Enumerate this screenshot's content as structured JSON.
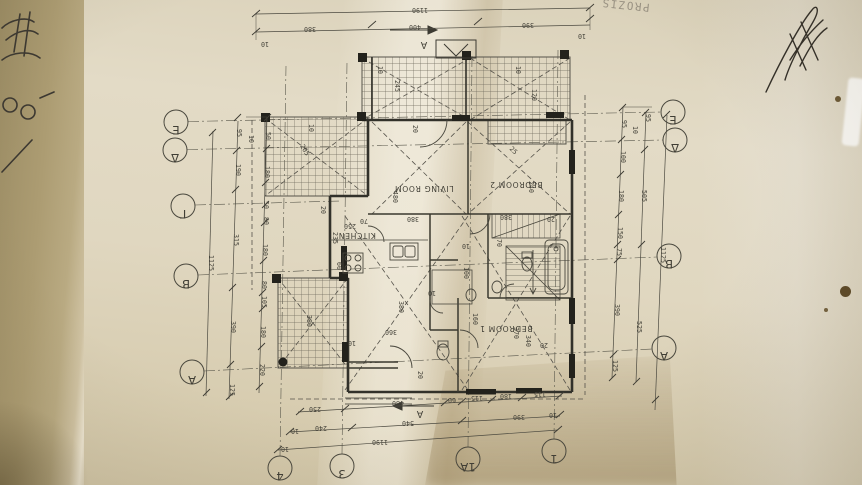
{
  "photo": {
    "stamp_text": "PROZIS",
    "description": "upside-down architectural floor plan on folded beige paper"
  },
  "colors": {
    "paper": "#e3dbc6",
    "paper_shadow": "#b3a37a",
    "ink": "#45433a",
    "wall_ink": "#32312a"
  },
  "plan": {
    "rooms": [
      {
        "label": "LIVING ROOM",
        "x": 424,
        "y": 186
      },
      {
        "label": "BEDROOM 2",
        "x": 516,
        "y": 182
      },
      {
        "label": "KITCHEN",
        "x": 357,
        "y": 233
      },
      {
        "label": "BEDROOM 1",
        "x": 506,
        "y": 326
      }
    ],
    "grid_bubbles": [
      {
        "label": "E",
        "x": 176,
        "y": 122
      },
      {
        "label": "Δ",
        "x": 175,
        "y": 150
      },
      {
        "label": "Γ",
        "x": 183,
        "y": 206
      },
      {
        "label": "B",
        "x": 186,
        "y": 276
      },
      {
        "label": "A",
        "x": 192,
        "y": 372
      },
      {
        "label": "E",
        "x": 673,
        "y": 112
      },
      {
        "label": "Δ",
        "x": 675,
        "y": 140
      },
      {
        "label": "B",
        "x": 669,
        "y": 256
      },
      {
        "label": "A",
        "x": 664,
        "y": 348
      },
      {
        "label": "4",
        "x": 280,
        "y": 468
      },
      {
        "label": "3",
        "x": 342,
        "y": 466
      },
      {
        "label": "1A",
        "x": 468,
        "y": 459
      },
      {
        "label": "1",
        "x": 554,
        "y": 451
      }
    ],
    "dims": [
      {
        "t": "1190",
        "x": 420,
        "y": 8,
        "r": 180
      },
      {
        "t": "380",
        "x": 310,
        "y": 27,
        "r": 180
      },
      {
        "t": "400",
        "x": 415,
        "y": 25,
        "r": 180
      },
      {
        "t": "390",
        "x": 528,
        "y": 23,
        "r": 180
      },
      {
        "t": "10",
        "x": 265,
        "y": 42,
        "r": 180
      },
      {
        "t": "10",
        "x": 582,
        "y": 34,
        "r": 180
      },
      {
        "t": "50",
        "x": 266,
        "y": 136,
        "r": 90
      },
      {
        "t": "180",
        "x": 265,
        "y": 172,
        "r": 90
      },
      {
        "t": "50",
        "x": 264,
        "y": 205,
        "r": 90
      },
      {
        "t": "80",
        "x": 264,
        "y": 221,
        "r": 90
      },
      {
        "t": "180",
        "x": 263,
        "y": 250,
        "r": 90
      },
      {
        "t": "80",
        "x": 262,
        "y": 285,
        "r": 90
      },
      {
        "t": "105",
        "x": 262,
        "y": 302,
        "r": 90
      },
      {
        "t": "180",
        "x": 261,
        "y": 332,
        "r": 90
      },
      {
        "t": "220",
        "x": 260,
        "y": 370,
        "r": 90
      },
      {
        "t": "95",
        "x": 237,
        "y": 133,
        "r": 90
      },
      {
        "t": "190",
        "x": 236,
        "y": 170,
        "r": 90
      },
      {
        "t": "315",
        "x": 234,
        "y": 240,
        "r": 90
      },
      {
        "t": "390",
        "x": 231,
        "y": 327,
        "r": 90
      },
      {
        "t": "125",
        "x": 230,
        "y": 390,
        "r": 90
      },
      {
        "t": "1125",
        "x": 209,
        "y": 263,
        "r": 90
      },
      {
        "t": "10",
        "x": 249,
        "y": 139,
        "r": 90
      },
      {
        "t": "95",
        "x": 622,
        "y": 124,
        "r": 90
      },
      {
        "t": "100",
        "x": 621,
        "y": 157,
        "r": 90
      },
      {
        "t": "180",
        "x": 619,
        "y": 196,
        "r": 90
      },
      {
        "t": "150",
        "x": 618,
        "y": 233,
        "r": 90
      },
      {
        "t": "75",
        "x": 617,
        "y": 252,
        "r": 90
      },
      {
        "t": "390",
        "x": 615,
        "y": 310,
        "r": 90
      },
      {
        "t": "125",
        "x": 613,
        "y": 366,
        "r": 90
      },
      {
        "t": "95",
        "x": 646,
        "y": 118,
        "r": 90
      },
      {
        "t": "505",
        "x": 642,
        "y": 196,
        "r": 90
      },
      {
        "t": "525",
        "x": 637,
        "y": 327,
        "r": 90
      },
      {
        "t": "1125",
        "x": 661,
        "y": 255,
        "r": 90
      },
      {
        "t": "10",
        "x": 633,
        "y": 130,
        "r": 90
      },
      {
        "t": "250",
        "x": 315,
        "y": 407,
        "r": 180
      },
      {
        "t": "480",
        "x": 398,
        "y": 401,
        "r": 180
      },
      {
        "t": "60",
        "x": 452,
        "y": 398,
        "r": 180
      },
      {
        "t": "115",
        "x": 477,
        "y": 396,
        "r": 180
      },
      {
        "t": "180",
        "x": 506,
        "y": 394,
        "r": 180
      },
      {
        "t": "115",
        "x": 540,
        "y": 392,
        "r": 180
      },
      {
        "t": "240",
        "x": 321,
        "y": 426,
        "r": 180
      },
      {
        "t": "540",
        "x": 408,
        "y": 421,
        "r": 180
      },
      {
        "t": "390",
        "x": 519,
        "y": 415,
        "r": 180
      },
      {
        "t": "10",
        "x": 295,
        "y": 429,
        "r": 180
      },
      {
        "t": "10",
        "x": 553,
        "y": 413,
        "r": 180
      },
      {
        "t": "1190",
        "x": 380,
        "y": 440,
        "r": 180
      },
      {
        "t": "10",
        "x": 285,
        "y": 447,
        "r": 180
      },
      {
        "t": "245",
        "x": 395,
        "y": 86,
        "r": 90
      },
      {
        "t": "120",
        "x": 532,
        "y": 95,
        "r": 90
      },
      {
        "t": "10",
        "x": 378,
        "y": 70,
        "r": 90
      },
      {
        "t": "10",
        "x": 516,
        "y": 70,
        "r": 90
      },
      {
        "t": "205",
        "x": 303,
        "y": 151,
        "r": 60
      },
      {
        "t": "10",
        "x": 309,
        "y": 128,
        "r": 90
      },
      {
        "t": "20",
        "x": 413,
        "y": 129,
        "r": 90
      },
      {
        "t": "480",
        "x": 393,
        "y": 197,
        "r": 90
      },
      {
        "t": "240",
        "x": 529,
        "y": 187,
        "r": 90
      },
      {
        "t": "25",
        "x": 512,
        "y": 152,
        "r": 45
      },
      {
        "t": "380",
        "x": 413,
        "y": 217,
        "r": 180
      },
      {
        "t": "380",
        "x": 506,
        "y": 215,
        "r": 180
      },
      {
        "t": "20",
        "x": 551,
        "y": 217,
        "r": 180
      },
      {
        "t": "70",
        "x": 364,
        "y": 219,
        "r": 180
      },
      {
        "t": "250",
        "x": 350,
        "y": 224,
        "r": 180
      },
      {
        "t": "235",
        "x": 333,
        "y": 238,
        "r": 90
      },
      {
        "t": "20",
        "x": 321,
        "y": 210,
        "r": 90
      },
      {
        "t": "60",
        "x": 337,
        "y": 266,
        "r": 90
      },
      {
        "t": "360",
        "x": 391,
        "y": 330,
        "r": 180
      },
      {
        "t": "380",
        "x": 399,
        "y": 307,
        "r": 90
      },
      {
        "t": "160",
        "x": 473,
        "y": 319,
        "r": 90
      },
      {
        "t": "10",
        "x": 432,
        "y": 291,
        "r": 180
      },
      {
        "t": "20",
        "x": 418,
        "y": 375,
        "r": 90
      },
      {
        "t": "370",
        "x": 514,
        "y": 333,
        "r": 90
      },
      {
        "t": "340",
        "x": 526,
        "y": 341,
        "r": 90
      },
      {
        "t": "20",
        "x": 544,
        "y": 343,
        "r": 180
      },
      {
        "t": "100",
        "x": 464,
        "y": 273,
        "r": 90
      },
      {
        "t": "70",
        "x": 497,
        "y": 243,
        "r": 90
      },
      {
        "t": "10",
        "x": 466,
        "y": 244,
        "r": 180
      },
      {
        "t": "380",
        "x": 307,
        "y": 321,
        "r": 90
      },
      {
        "t": "10",
        "x": 352,
        "y": 341,
        "r": 180
      },
      {
        "t": "A",
        "x": 424,
        "y": 42,
        "r": 180,
        "c": "dimA"
      },
      {
        "t": "A",
        "x": 420,
        "y": 411,
        "r": 180,
        "c": "dimA"
      }
    ]
  }
}
